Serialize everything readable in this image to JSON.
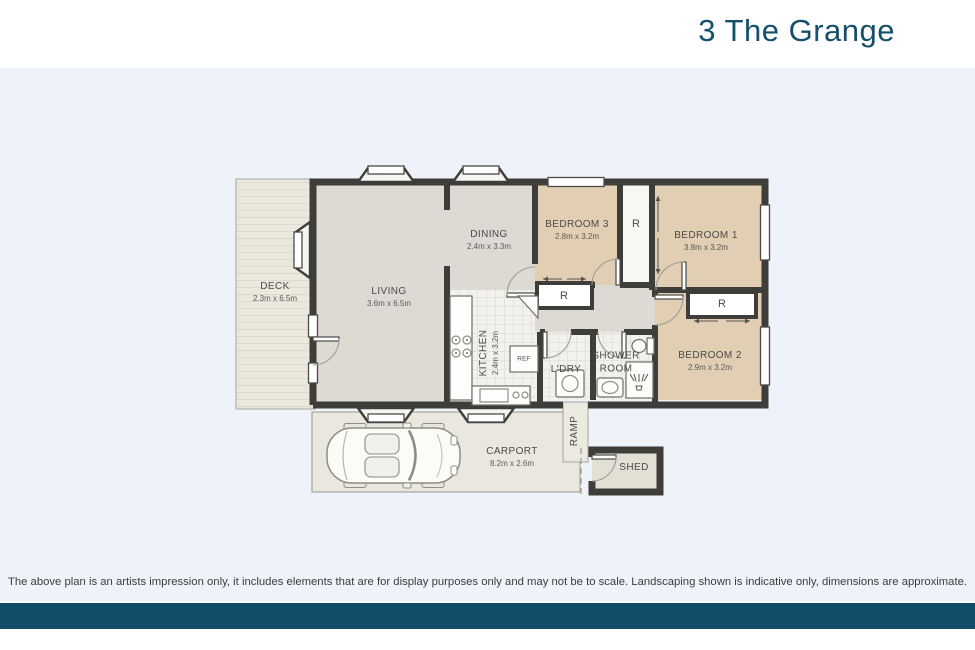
{
  "title": "3 The Grange",
  "rooms": {
    "deck": {
      "name": "DECK",
      "dims": "2.3m x 6.5m"
    },
    "living": {
      "name": "LIVING",
      "dims": "3.6m x 6.5m"
    },
    "dining": {
      "name": "DINING",
      "dims": "2.4m x 3.3m"
    },
    "kitchen": {
      "name": "KITCHEN",
      "dims": "2.4m x 3.2m"
    },
    "bedroom1": {
      "name": "BEDROOM 1",
      "dims": "3.8m x 3.2m"
    },
    "bedroom2": {
      "name": "BEDROOM 2",
      "dims": "2.9m x 3.2m"
    },
    "bedroom3": {
      "name": "BEDROOM 3",
      "dims": "2.8m x 3.2m"
    },
    "shower_room": {
      "line1": "SHOWER",
      "line2": "ROOM"
    },
    "laundry": {
      "name": "L'DRY"
    },
    "carport": {
      "name": "CARPORT",
      "dims": "8.2m x 2.6m"
    },
    "ramp": {
      "name": "RAMP"
    },
    "shed": {
      "name": "SHED"
    }
  },
  "labels": {
    "robe": "R",
    "fridge": "REF"
  },
  "disclaimer": "The above plan is an artists impression only, it includes elements that are for display purposes only and may not be to scale. Landscaping shown is indicative only, dimensions are approximate.",
  "colors": {
    "accent": "#14506c",
    "plan_bg": "#edf3f8",
    "footer": "#114d66",
    "wall": "#3f3d3a",
    "bedroom": "#e1ceb3",
    "neutral": "#dcdad2",
    "wet": "#f2f1ec",
    "outdoor": "#eae7de",
    "deck": "#ebe8de",
    "disclaimer": "#3c3c3c"
  }
}
